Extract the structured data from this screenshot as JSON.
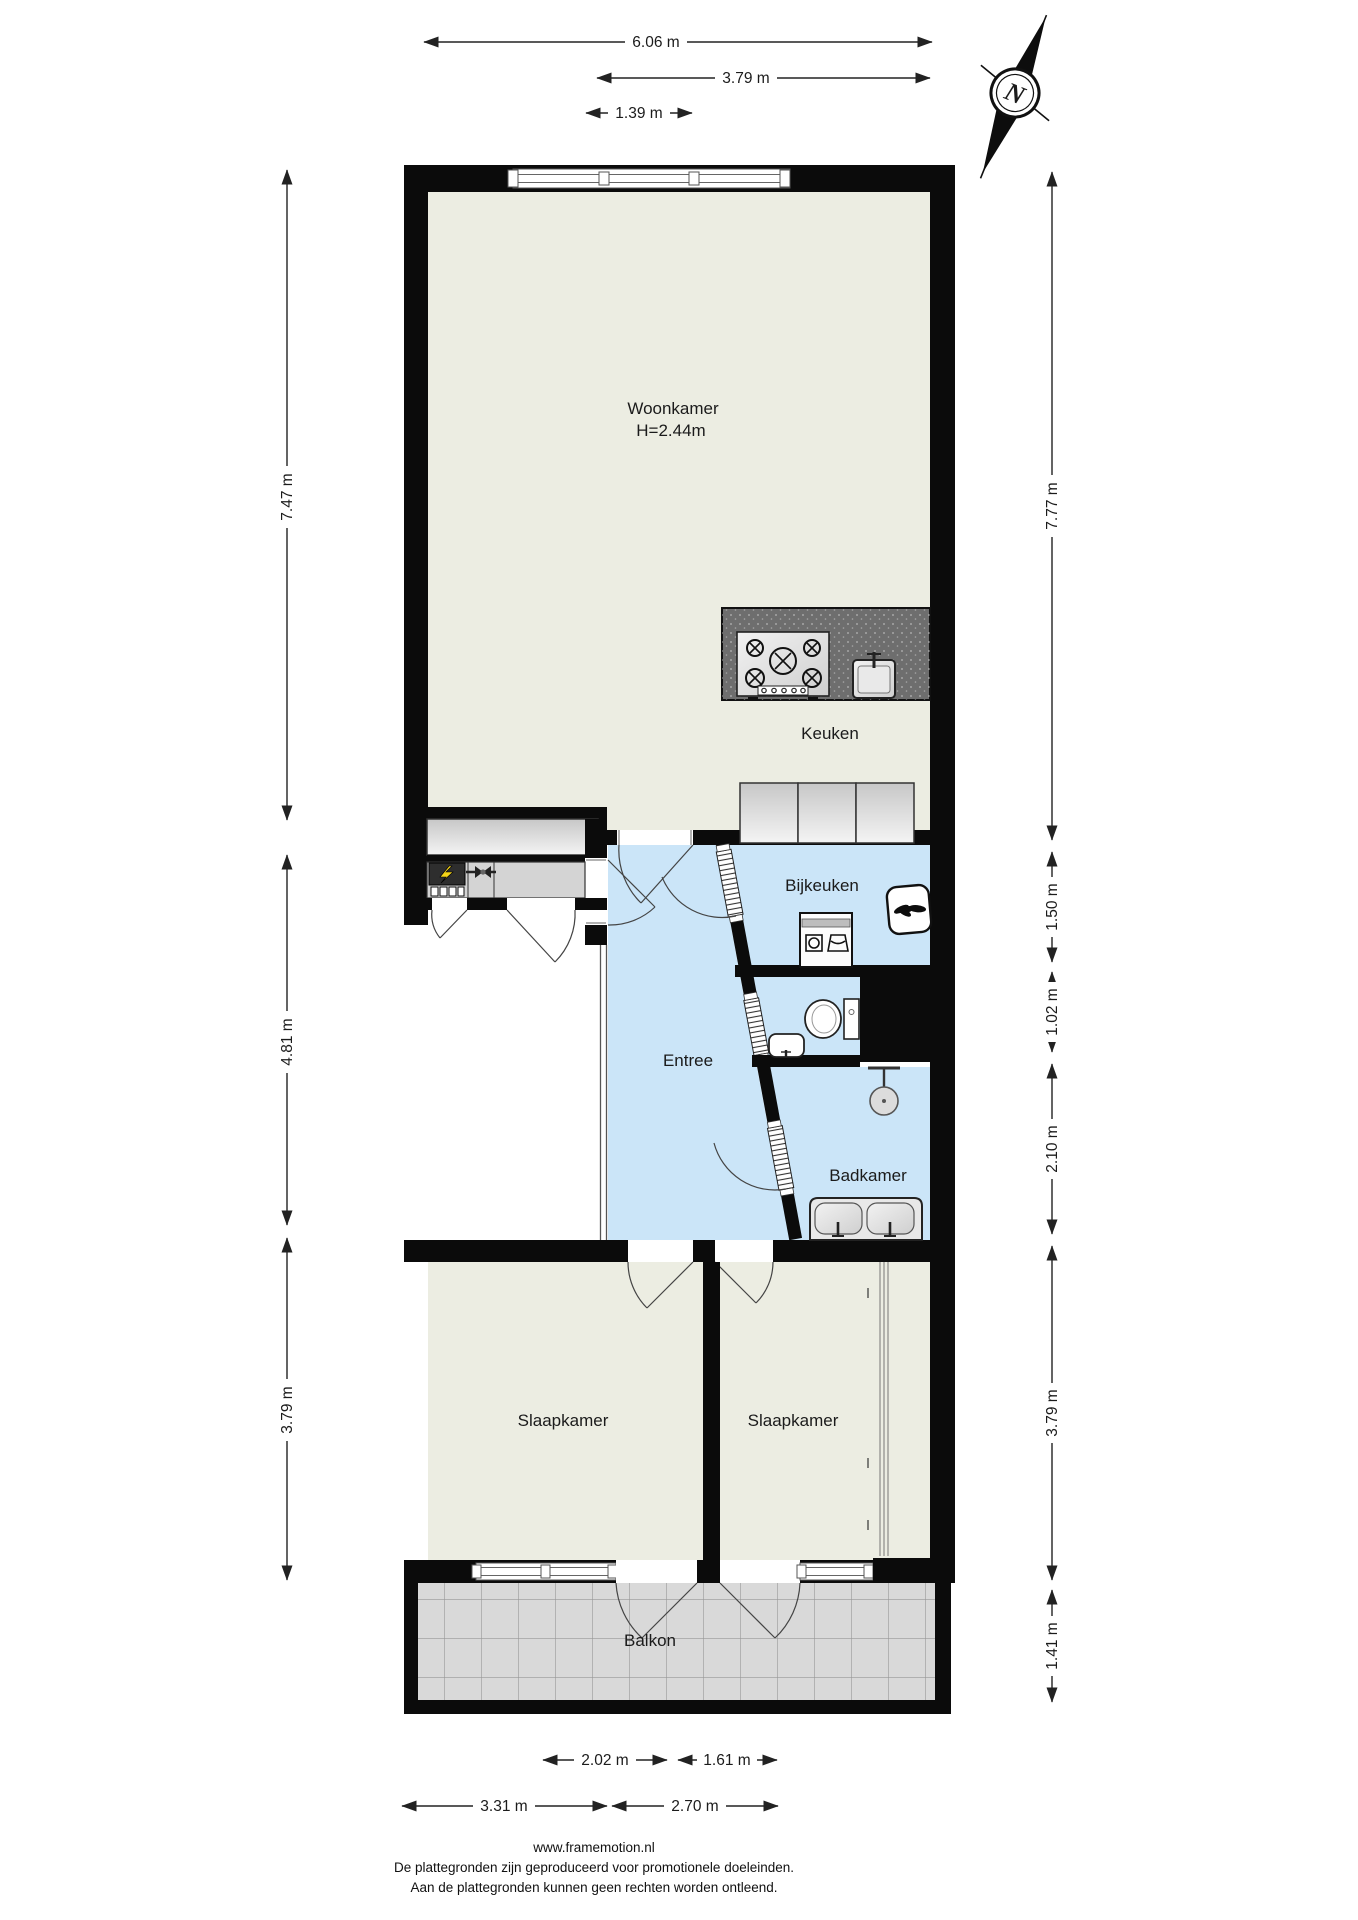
{
  "rooms": {
    "woonkamer": {
      "name": "Woonkamer",
      "ceiling": "H=2.44m"
    },
    "keuken": {
      "name": "Keuken"
    },
    "bijkeuken": {
      "name": "Bijkeuken"
    },
    "entree": {
      "name": "Entree"
    },
    "badkamer": {
      "name": "Badkamer"
    },
    "slaapkamer1": {
      "name": "Slaapkamer"
    },
    "slaapkamer2": {
      "name": "Slaapkamer"
    },
    "balkon": {
      "name": "Balkon"
    }
  },
  "compass": {
    "north_label": "N"
  },
  "dimensions": {
    "top": [
      "6.06 m",
      "3.79 m",
      "1.39 m"
    ],
    "left": [
      "7.47 m",
      "4.81 m",
      "3.79 m"
    ],
    "right": [
      "7.77 m",
      "1.50 m",
      "1.02 m",
      "2.10 m",
      "3.79 m",
      "1.41 m"
    ],
    "bottom_upper": [
      "2.02 m",
      "1.61 m"
    ],
    "bottom_lower": [
      "3.31 m",
      "2.70 m"
    ]
  },
  "footer": {
    "website": "www.framemotion.nl",
    "disclaimer1": "De plattegronden zijn geproduceerd voor promotionele doeleinden.",
    "disclaimer2": "Aan de plattegronden kunnen geen rechten worden ontleend."
  },
  "colors": {
    "wall": "#0b0b0b",
    "floor_living": "#ECEDE2",
    "floor_wet": "#CBE5F8",
    "balcony_tile": "#D9D9D9",
    "counter": "#6E6E6E",
    "cabinet": "#D6D6D6",
    "accent_bolt": "#F5D418"
  }
}
